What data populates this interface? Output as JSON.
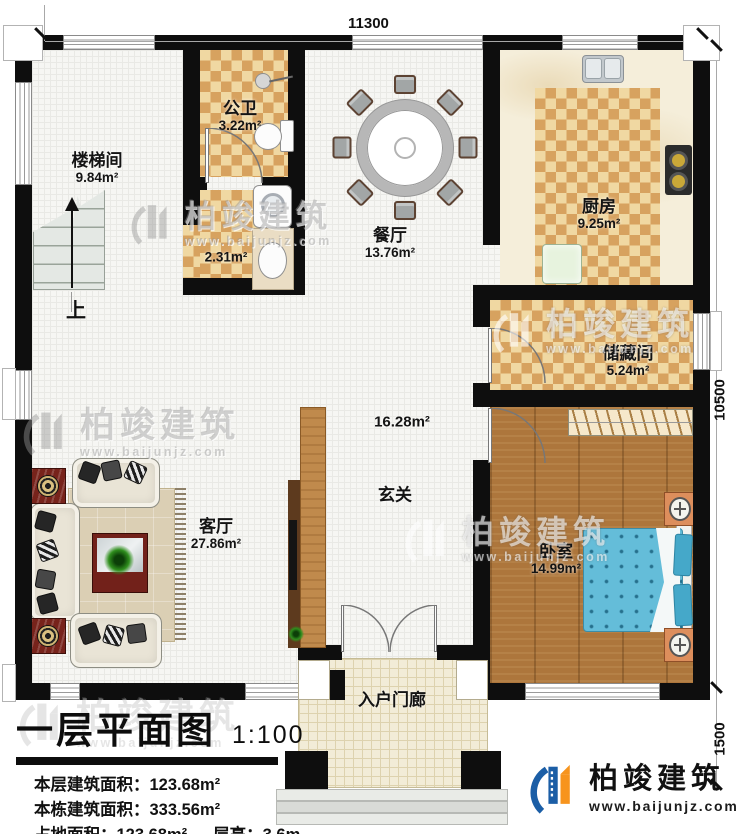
{
  "dimensions": {
    "top": "11300",
    "right": "10500",
    "porch": "1500"
  },
  "rooms": {
    "stairwell": {
      "name": "楼梯间",
      "area": "9.84m²"
    },
    "bathroom": {
      "name": "公卫",
      "area": "3.22m²"
    },
    "utility": {
      "area": "2.31m²"
    },
    "dining": {
      "name": "餐厅",
      "area": "13.76m²"
    },
    "kitchen": {
      "name": "厨房",
      "area": "9.25m²"
    },
    "storage": {
      "name": "储藏间",
      "area": "5.24m²"
    },
    "foyer": {
      "name": "玄关",
      "area": "16.28m²"
    },
    "living": {
      "name": "客厅",
      "area": "27.86m²"
    },
    "bedroom": {
      "name": "卧室",
      "area": "14.99m²"
    },
    "porch": {
      "name": "入户门廊"
    }
  },
  "stairs": {
    "up_label": "上"
  },
  "title_block": {
    "title": "一层平面图",
    "scale": "1:100",
    "stats": {
      "floor_area_label": "本层建筑面积：",
      "floor_area_value": "123.68m²",
      "building_area_label": "本栋建筑面积：",
      "building_area_value": "333.56m²",
      "footprint_label": "占地面积：",
      "footprint_value": "123.68m²",
      "height_label": "层高：",
      "height_value": "3.6m"
    }
  },
  "watermark": {
    "brand": "柏竣建筑",
    "url": "www.baijunjz.com"
  },
  "logo": {
    "brand": "柏竣建筑",
    "url": "www.baijunjz.com"
  },
  "colors": {
    "wall": "#0e0e0e",
    "accent_blue": "#1b5ea6",
    "accent_orange": "#f7941d",
    "tile_light": "#f0d8a2",
    "tile_dark": "#d7a25f"
  }
}
